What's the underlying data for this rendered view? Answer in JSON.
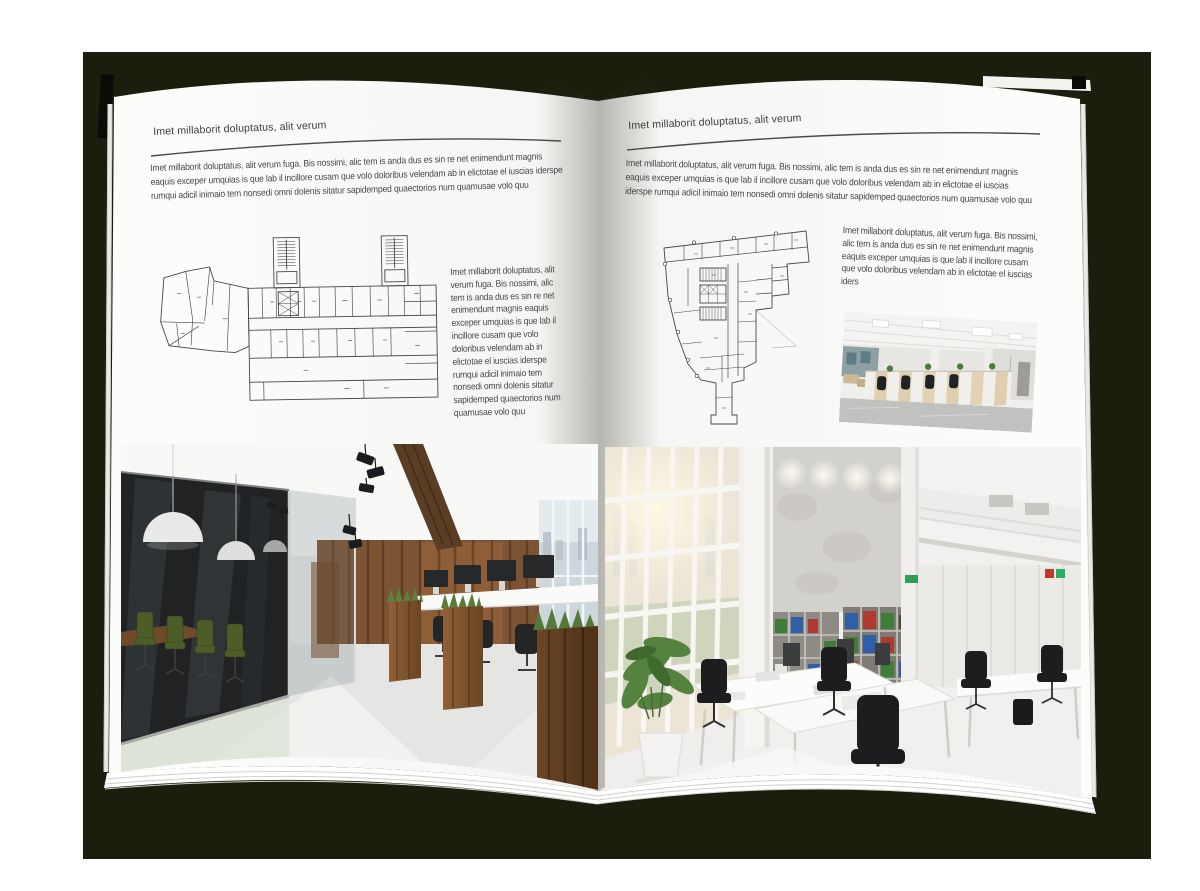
{
  "palette": {
    "backdrop": "#1c1e0d",
    "page": "#fbfbfa",
    "text": "#474747",
    "rule": "#4b4b4b",
    "plan_line": "#474747",
    "wood": "#7d5433",
    "glass_dark": "#202224",
    "chair_green": "#4c5d28",
    "grass": "#5e8140",
    "concrete": "#d3d1cc",
    "binder_green": "#3f7d3a",
    "binder_blue": "#2f5fa8",
    "binder_red": "#b03a30",
    "carpet": "#bfc2bf"
  },
  "left_page": {
    "header": "Imet millaborit doluptatus, alit verum",
    "intro": "Imet millaborit doluptatus, alit verum fuga. Bis nossimi, alic tem is anda dus es sin re net enimendunt magnis eaquis exceper umquias is que lab il incillore cusam que volo doloribus velendam ab in elictotae el iuscias iderspe rumqui adicil inimaio tem nonsedi omni dolenis sitatur sapidemped quaectorios num quamusae volo quu",
    "side_text": "Imet millaborit doluptatus, alit verum fuga. Bis nossimi, alic tem is anda dus es sin re net enimendunt magnis eaquis exceper umquias is que lab il incillore cusam que volo doloribus velendam ab in elictotae el iuscias iderspe rumqui adicil inimaio tem nonsedi omni dolenis sitatur sapidemped quaectorios num quamusae volo quu",
    "floor_plan_name": "wide-building-floor-plan",
    "photo_name": "office-interior-dark-wood-glass-meeting-room"
  },
  "right_page": {
    "header": "Imet millaborit doluptatus, alit verum",
    "intro": "Imet millaborit doluptatus, alit verum fuga. Bis nossimi, alic tem is anda dus es sin re net enimendunt magnis eaquis exceper umquias is que lab il incillore cusam que volo doloribus velendam ab in elictotae el iuscias iderspe rumqui adicil inimaio tem nonsedi omni dolenis sitatur sapidemped quaectorios num quamusae volo quu",
    "side_text": "Imet millaborit doluptatus, alit verum fuga. Bis nossimi, alic tem is anda dus es sin re net enimendunt magnis eaquis exceper umquias is que lab il incillore cusam que volo doloribus velendam ab in elictotae el iuscias iders",
    "floor_plan_name": "irregular-tower-floor-plan",
    "photo_small_name": "open-plan-office-cubicles",
    "photo_name": "bright-double-height-office"
  }
}
